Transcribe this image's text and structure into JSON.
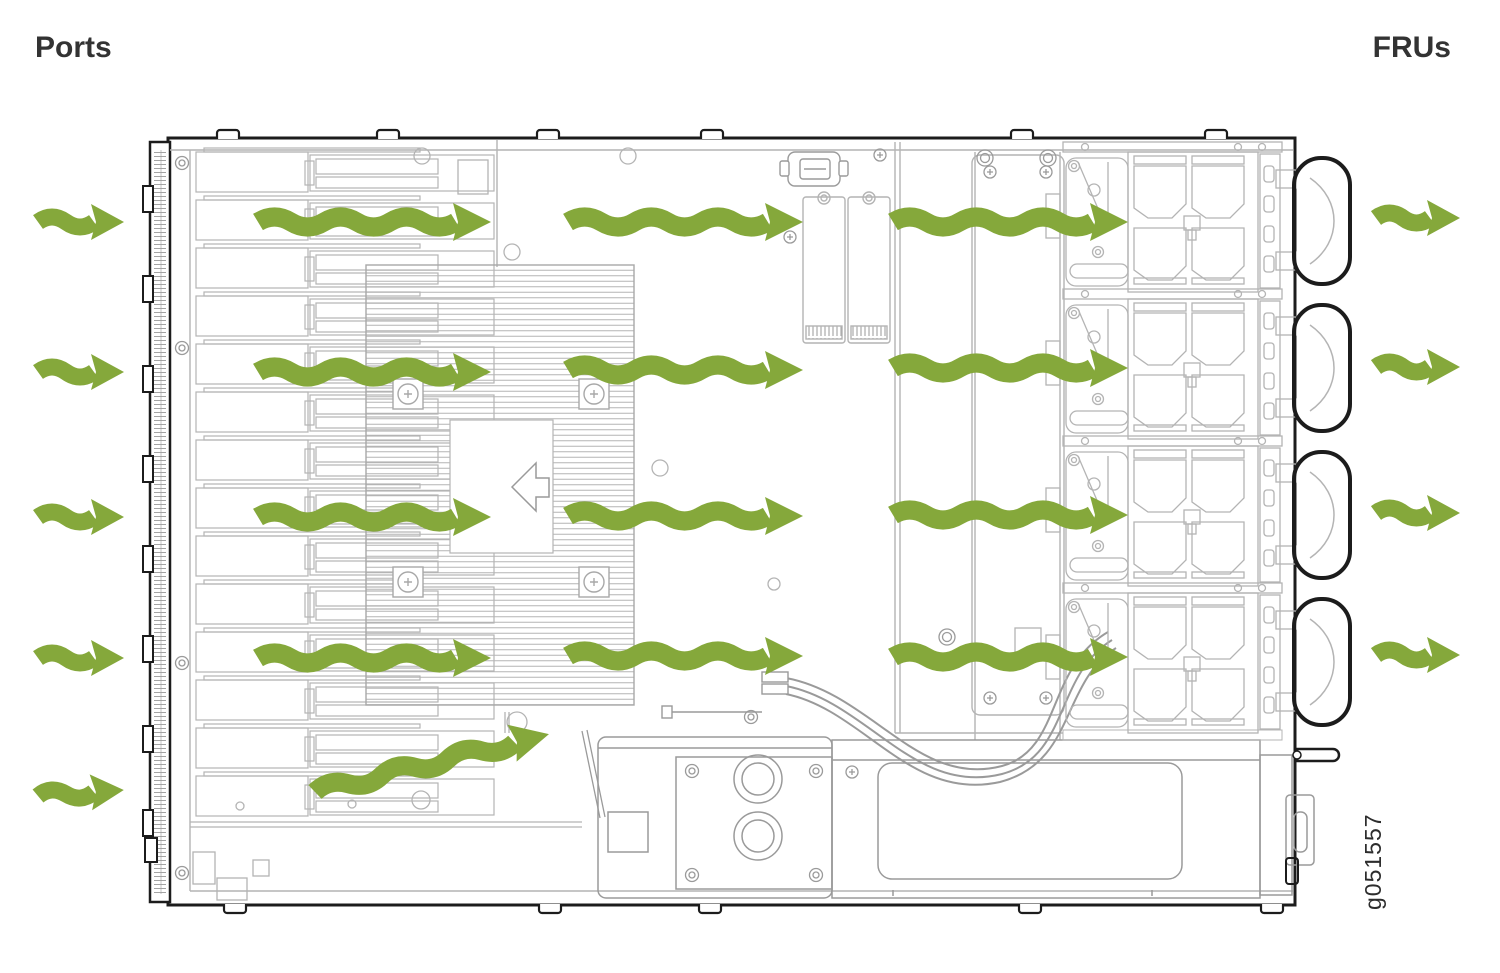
{
  "page": {
    "title_left": "Ports",
    "title_right": "FRUs",
    "figure_id": "g051557"
  },
  "colors": {
    "arrow": "#85a83b",
    "chassis": "#1c1c1c",
    "line": "#b4b4b4",
    "line_mid": "#9a9a9a",
    "text": "#333333"
  },
  "diagram": {
    "type": "airflow-diagram",
    "description": "Top view of chassis: cool air enters at the Ports side (left), flows across the midplane and heatsink, and exhausts through the fan FRUs (right).",
    "chassis": {
      "port_cages": 14,
      "fan_trays": 4,
      "dimm_slots": 2
    },
    "airflow_arrows": [
      {
        "x": 38,
        "y": 222,
        "len": 56,
        "angle": 0,
        "zone": "intake"
      },
      {
        "x": 38,
        "y": 372,
        "len": 56,
        "angle": 0,
        "zone": "intake"
      },
      {
        "x": 38,
        "y": 517,
        "len": 56,
        "angle": 0,
        "zone": "intake"
      },
      {
        "x": 38,
        "y": 658,
        "len": 56,
        "angle": 0,
        "zone": "intake"
      },
      {
        "x": 38,
        "y": 796,
        "len": 56,
        "angle": -4,
        "zone": "intake"
      },
      {
        "x": 258,
        "y": 222,
        "len": 198,
        "angle": 0,
        "zone": "internal"
      },
      {
        "x": 258,
        "y": 372,
        "len": 198,
        "angle": 0,
        "zone": "internal"
      },
      {
        "x": 258,
        "y": 517,
        "len": 198,
        "angle": 0,
        "zone": "internal"
      },
      {
        "x": 258,
        "y": 658,
        "len": 198,
        "angle": 0,
        "zone": "internal"
      },
      {
        "x": 568,
        "y": 222,
        "len": 200,
        "angle": 0,
        "zone": "internal"
      },
      {
        "x": 568,
        "y": 370,
        "len": 200,
        "angle": 0,
        "zone": "internal"
      },
      {
        "x": 568,
        "y": 516,
        "len": 200,
        "angle": 0,
        "zone": "internal"
      },
      {
        "x": 568,
        "y": 656,
        "len": 200,
        "angle": 0,
        "zone": "internal"
      },
      {
        "x": 893,
        "y": 222,
        "len": 200,
        "angle": 0,
        "zone": "internal"
      },
      {
        "x": 893,
        "y": 368,
        "len": 200,
        "angle": 0,
        "zone": "internal"
      },
      {
        "x": 893,
        "y": 515,
        "len": 200,
        "angle": 0,
        "zone": "internal"
      },
      {
        "x": 893,
        "y": 657,
        "len": 200,
        "angle": 0,
        "zone": "internal"
      },
      {
        "x": 315,
        "y": 792,
        "len": 206,
        "angle": -13.9,
        "zone": "internal"
      },
      {
        "x": 1376,
        "y": 218,
        "len": 54,
        "angle": 0,
        "zone": "exhaust"
      },
      {
        "x": 1376,
        "y": 367,
        "len": 54,
        "angle": 0,
        "zone": "exhaust"
      },
      {
        "x": 1376,
        "y": 513,
        "len": 54,
        "angle": 0,
        "zone": "exhaust"
      },
      {
        "x": 1376,
        "y": 655,
        "len": 54,
        "angle": 0,
        "zone": "exhaust"
      }
    ]
  }
}
